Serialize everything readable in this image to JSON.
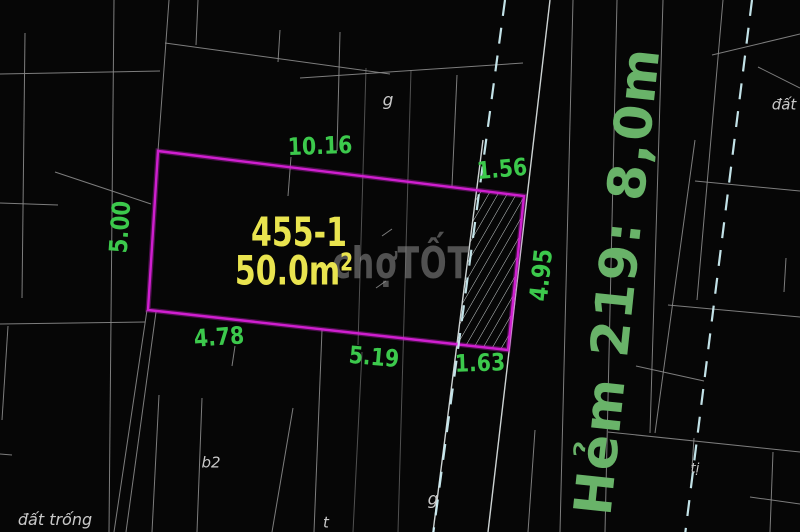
{
  "canvas": {
    "width": 800,
    "height": 532,
    "background": "#060606"
  },
  "colors": {
    "plot_outline": "#cf1fcf",
    "dimension_text": "#3cc94c",
    "plot_text": "#e9e44f",
    "street_text": "#69b369",
    "small_text": "#c9c9c9",
    "watermark_text": "#8f8f8f",
    "line_minor": "#8a8a8a",
    "line_faint": "#5e5e5e",
    "line_bright": "#d8dede",
    "line_dashed": "#cdeef4",
    "hatch": "#c9cfcf"
  },
  "plot": {
    "id_label": {
      "text": "455-1",
      "x": 299,
      "y": 233,
      "size": 40,
      "sx": 0.75
    },
    "area_label": {
      "text": "50.0m",
      "sup": "2",
      "x": 294,
      "y": 271,
      "size": 40,
      "sx": 0.75
    },
    "outline": [
      [
        158,
        151
      ],
      [
        524,
        196
      ],
      [
        508,
        350
      ],
      [
        148,
        310
      ]
    ],
    "hatch_region": [
      [
        476,
        190
      ],
      [
        524,
        196
      ],
      [
        508,
        350
      ],
      [
        457,
        344
      ]
    ]
  },
  "dimensions": [
    {
      "label": "10.16",
      "x": 320,
      "y": 146,
      "rot": -2,
      "size": 24,
      "sx": 0.85
    },
    {
      "label": "1.56",
      "x": 502,
      "y": 169,
      "rot": -5,
      "size": 24,
      "sx": 0.85
    },
    {
      "label": "5.00",
      "x": 120,
      "y": 227,
      "rot": -86,
      "size": 25,
      "sx": 0.85
    },
    {
      "label": "4.95",
      "x": 541,
      "y": 275,
      "rot": -84,
      "size": 25,
      "sx": 0.85
    },
    {
      "label": "4.78",
      "x": 219,
      "y": 337,
      "rot": -4,
      "size": 24,
      "sx": 0.85
    },
    {
      "label": "5.19",
      "x": 374,
      "y": 357,
      "rot": 5,
      "size": 24,
      "sx": 0.85
    },
    {
      "label": "1.63",
      "x": 480,
      "y": 363,
      "rot": -2,
      "size": 24,
      "sx": 0.85
    }
  ],
  "street_label": {
    "text": "Hẻm 219: 8,0m",
    "x": 618,
    "y": 281,
    "rot": -84,
    "size": 52
  },
  "watermark": {
    "text": "chợTỐT",
    "x": 401,
    "y": 264,
    "size": 44,
    "sx": 0.72
  },
  "small_labels": [
    {
      "text": "g",
      "x": 388,
      "y": 101,
      "size": 17
    },
    {
      "text": "đất",
      "x": 784,
      "y": 105,
      "size": 15
    },
    {
      "text": "đất trống",
      "x": 55,
      "y": 520,
      "size": 16
    },
    {
      "text": "b2",
      "x": 211,
      "y": 463,
      "size": 15
    },
    {
      "text": "g",
      "x": 433,
      "y": 500,
      "size": 17
    },
    {
      "text": "t",
      "x": 326,
      "y": 523,
      "size": 15
    },
    {
      "text": "tị",
      "x": 695,
      "y": 469,
      "size": 13
    }
  ],
  "lines": {
    "minor": [
      [
        25,
        33,
        22,
        298
      ],
      [
        0,
        74,
        160,
        71
      ],
      [
        114,
        0,
        109,
        532
      ],
      [
        169,
        0,
        158,
        151
      ],
      [
        198,
        0,
        196,
        45
      ],
      [
        165,
        43,
        390,
        74
      ],
      [
        300,
        78,
        523,
        63
      ],
      [
        280,
        30,
        278,
        62
      ],
      [
        55,
        172,
        151,
        204
      ],
      [
        0,
        203,
        58,
        205
      ],
      [
        340,
        32,
        337,
        151
      ],
      [
        291,
        157,
        288,
        196
      ],
      [
        457,
        75,
        452,
        186
      ],
      [
        0,
        324,
        145,
        322
      ],
      [
        8,
        326,
        2,
        420
      ],
      [
        147,
        310,
        114,
        532
      ],
      [
        156,
        312,
        126,
        532
      ],
      [
        159,
        395,
        152,
        532
      ],
      [
        202,
        398,
        197,
        532
      ],
      [
        235,
        346,
        232,
        366
      ],
      [
        322,
        330,
        314,
        532
      ],
      [
        293,
        408,
        272,
        532
      ],
      [
        535,
        430,
        528,
        532
      ],
      [
        573,
        0,
        560,
        532
      ],
      [
        617,
        0,
        605,
        532
      ],
      [
        663,
        0,
        650,
        433
      ],
      [
        723,
        0,
        697,
        300
      ],
      [
        712,
        55,
        800,
        34
      ],
      [
        758,
        67,
        800,
        88
      ],
      [
        695,
        181,
        800,
        191
      ],
      [
        668,
        305,
        800,
        317
      ],
      [
        608,
        432,
        800,
        452
      ],
      [
        750,
        497,
        800,
        504
      ],
      [
        773,
        452,
        770,
        532
      ],
      [
        694,
        438,
        692,
        468
      ],
      [
        695,
        140,
        655,
        433
      ],
      [
        636,
        366,
        704,
        381
      ],
      [
        786,
        258,
        784,
        292
      ],
      [
        0,
        454,
        12,
        455
      ],
      [
        382,
        236,
        392,
        229
      ],
      [
        376,
        288,
        386,
        281
      ]
    ],
    "faint": [
      [
        366,
        68,
        358,
        345
      ],
      [
        411,
        70,
        398,
        532
      ],
      [
        362,
        352,
        353,
        532
      ]
    ],
    "bright": [
      [
        550,
        0,
        488,
        532
      ],
      [
        483,
        140,
        433,
        532
      ]
    ],
    "dashed": [
      [
        505,
        0,
        433,
        535
      ],
      [
        752,
        0,
        685,
        535
      ]
    ]
  }
}
